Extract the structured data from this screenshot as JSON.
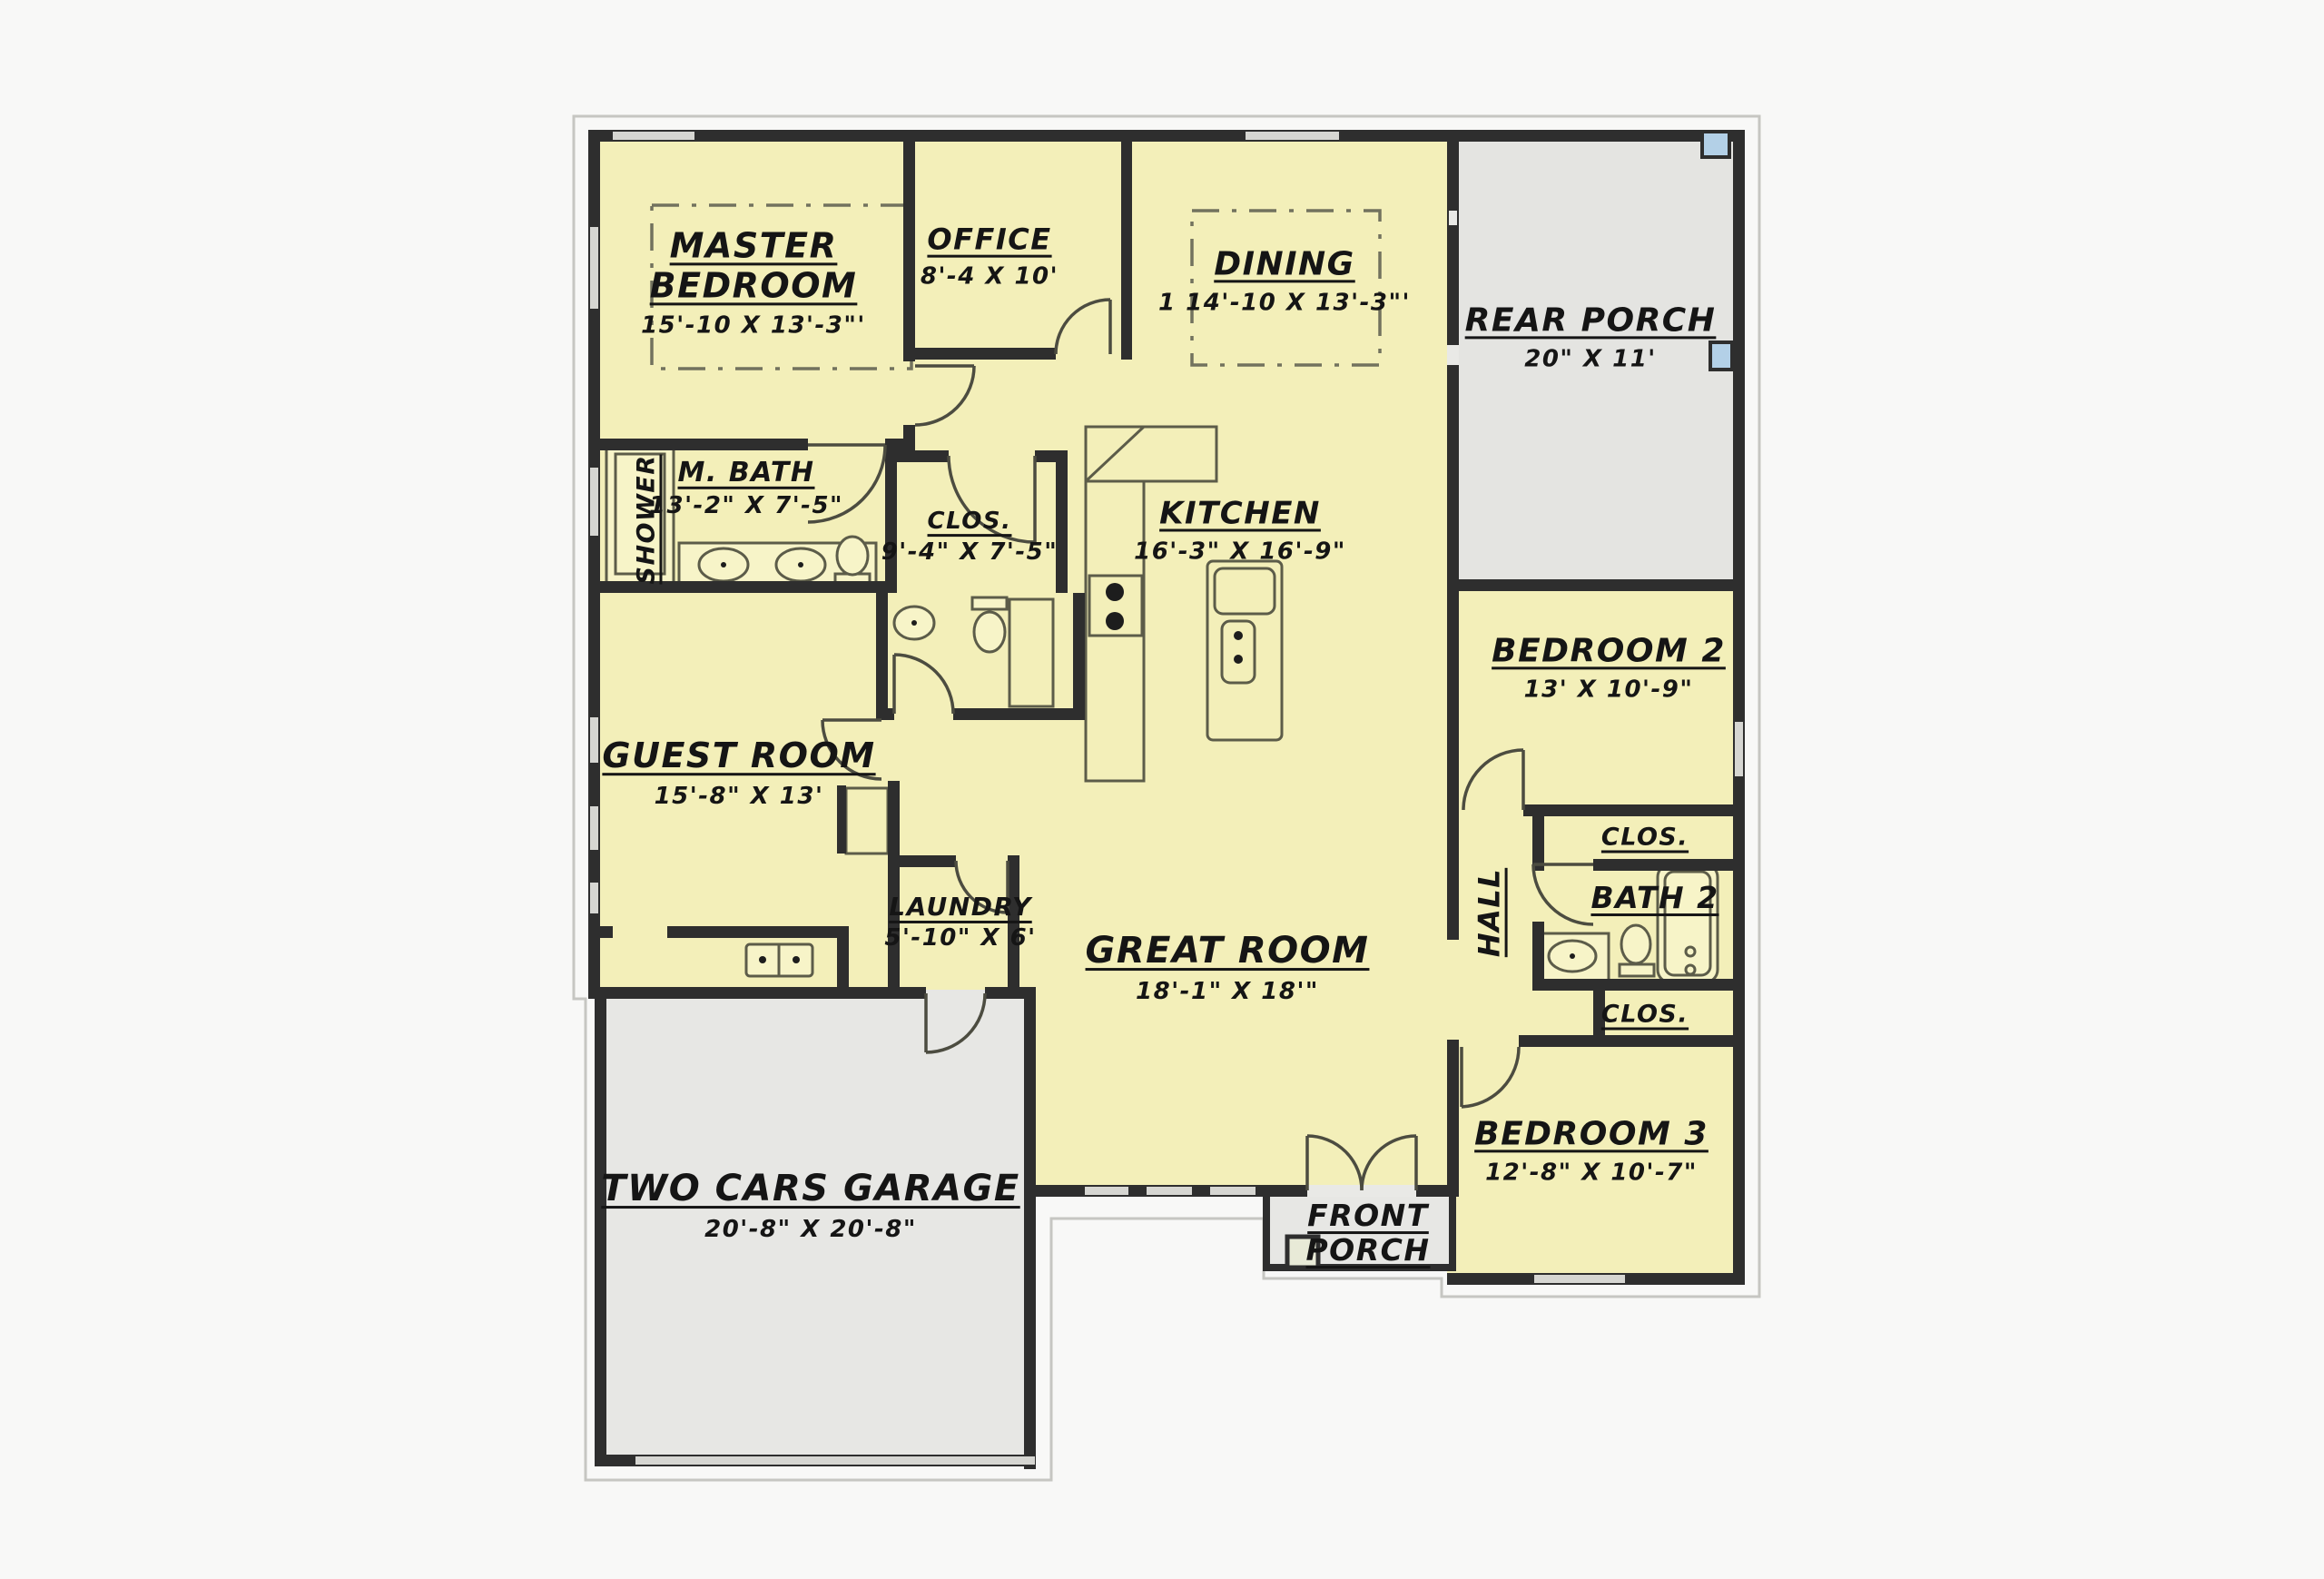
{
  "title": "House floor plan",
  "palette": {
    "floor_yellow": "#f3efb9",
    "porch_gray": "#e4e4e1",
    "wall_dark": "#2e2e2e",
    "window_gray": "#d6d6d2",
    "accent_blue": "#b3d0e7",
    "background": "#f8f8f7",
    "fixture_fill": "#f7f4c8"
  },
  "rooms": [
    {
      "id": "master-bedroom",
      "label": "MASTER BEDROOM",
      "dims": "15'-10 X 13'-3\"'"
    },
    {
      "id": "office",
      "label": "OFFICE",
      "dims": "8'-4 X 10'"
    },
    {
      "id": "dining",
      "label": "DINING",
      "dims": "1 14'-10 X 13'-3\"'"
    },
    {
      "id": "rear-porch",
      "label": "REAR PORCH",
      "dims": "20\" X  11'"
    },
    {
      "id": "m-bath",
      "label": "M. BATH",
      "dims": "13'-2\" X 7'-5\""
    },
    {
      "id": "shower",
      "label": "SHOWER",
      "dims": ""
    },
    {
      "id": "master-closet",
      "label": "CLOS.",
      "dims": "9'-4\" X 7'-5\""
    },
    {
      "id": "kitchen",
      "label": "KITCHEN",
      "dims": "16'-3\" X  16'-9\""
    },
    {
      "id": "bedroom-2",
      "label": "BEDROOM 2",
      "dims": "13' X 10'-9\""
    },
    {
      "id": "guest-room",
      "label": "GUEST ROOM",
      "dims": "15'-8\" X  13'"
    },
    {
      "id": "hall",
      "label": "HALL",
      "dims": ""
    },
    {
      "id": "closet-top",
      "label": "CLOS.",
      "dims": ""
    },
    {
      "id": "bath-2",
      "label": "BATH 2",
      "dims": ""
    },
    {
      "id": "closet-bottom",
      "label": "CLOS.",
      "dims": ""
    },
    {
      "id": "laundry",
      "label": "LAUNDRY",
      "dims": "5'-10\" X 6'"
    },
    {
      "id": "great-room",
      "label": "GREAT ROOM",
      "dims": "18'-1\" X  18'\""
    },
    {
      "id": "bedroom-3",
      "label": "BEDROOM 3",
      "dims": "12'-8\" X 10'-7\""
    },
    {
      "id": "garage",
      "label": "TWO CARS GARAGE",
      "dims": "20'-8\" X  20'-8\""
    },
    {
      "id": "front-porch",
      "label": "FRONT PORCH",
      "dims": ""
    }
  ]
}
